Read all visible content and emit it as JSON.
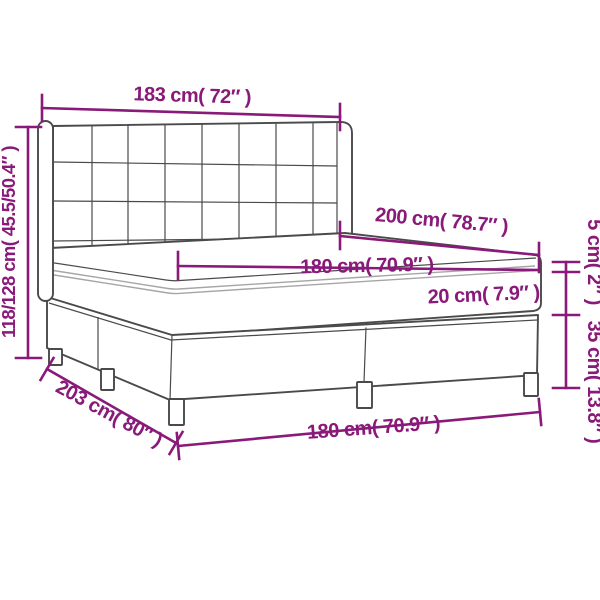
{
  "diagram": {
    "title": "bed-with-dimensions",
    "accent_color": "#891a79",
    "line_color": "#4a4a4a",
    "labels": {
      "headboard_width": "183 cm( 72″ )",
      "overall_height": "118/128 cm( 45.5/50.4″ )",
      "mattress_length": "200 cm( 78.7″ )",
      "mattress_width_top": "180 cm( 70.9″ )",
      "mattress_height": "20 cm( 7.9″ )",
      "top_lip_height": "5 cm( 2″ )",
      "base_height": "35 cm( 13.8″ )",
      "base_length": "203 cm( 80″ )",
      "base_width_bottom": "180 cm( 70.9″ )"
    }
  }
}
